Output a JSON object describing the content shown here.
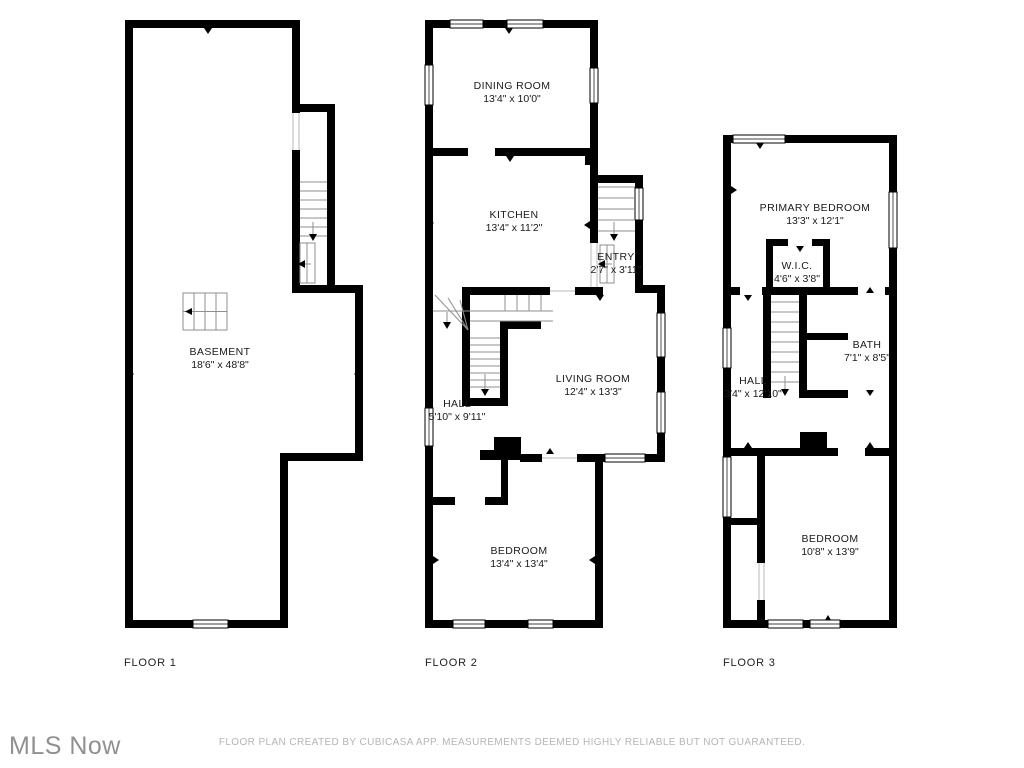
{
  "floors": [
    {
      "label": "FLOOR 1",
      "rooms": [
        {
          "name": "BASEMENT",
          "dims": "18'6\" x 48'8\""
        }
      ]
    },
    {
      "label": "FLOOR 2",
      "rooms": [
        {
          "name": "DINING ROOM",
          "dims": "13'4\" x 10'0\""
        },
        {
          "name": "KITCHEN",
          "dims": "13'4\" x 11'2\""
        },
        {
          "name": "ENTRY",
          "dims": "2'7\" x 3'11\""
        },
        {
          "name": "LIVING ROOM",
          "dims": "12'4\" x 13'3\""
        },
        {
          "name": "HALL",
          "dims": "5'10\" x 9'11\""
        },
        {
          "name": "BEDROOM",
          "dims": "13'4\" x 13'4\""
        }
      ]
    },
    {
      "label": "FLOOR 3",
      "rooms": [
        {
          "name": "PRIMARY BEDROOM",
          "dims": "13'3\" x 12'1\""
        },
        {
          "name": "W.I.C.",
          "dims": "4'6\" x 3'8\""
        },
        {
          "name": "BATH",
          "dims": "7'1\" x 8'5\""
        },
        {
          "name": "HALL",
          "dims": "3'4\" x 12'10\""
        },
        {
          "name": "BEDROOM",
          "dims": "10'8\" x 13'9\""
        }
      ]
    }
  ],
  "footer": {
    "logo_text": "MLS Now",
    "disclaimer": "FLOOR PLAN CREATED BY CUBICASA APP. MEASUREMENTS DEEMED HIGHLY RELIABLE BUT NOT GUARANTEED."
  },
  "colors": {
    "wall": "#000000",
    "background": "#ffffff",
    "stair_line": "#8f8f8f",
    "logo_text": "#909090",
    "disclaimer_text": "#b5b5b5"
  },
  "icons": {
    "stair_direction_arrow": "solid triangle with stem line",
    "door_swing_tick": "small solid triangle on wall opening"
  }
}
